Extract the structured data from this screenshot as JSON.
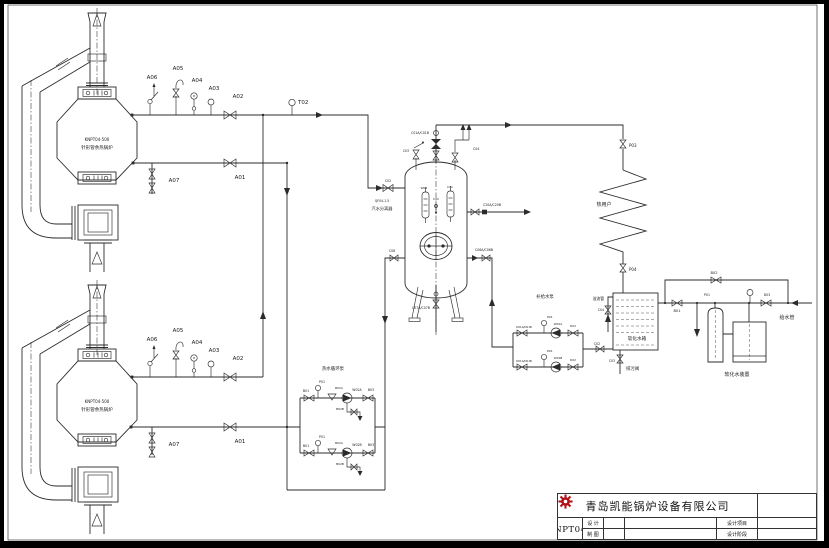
{
  "colors": {
    "line": "#2b2b2b",
    "background": "#ffffff",
    "frame": "#000000",
    "logo_red": "#b01217"
  },
  "title_block": {
    "company": "青岛凯能锅炉设备有限公司",
    "drawing_title": "2台KNPT04-500",
    "design_label": "设 计",
    "draft_label": "制 图",
    "project_label": "设计项目",
    "stage_label": "设计阶段"
  },
  "equipment": {
    "boiler_model": "KNPT04-500",
    "boiler_name": "针形管余热锅炉",
    "separator": "汽水分离器",
    "heat_user": "热用户",
    "soft_water_tank": "软化水箱",
    "softener_unit": "软化水装置",
    "makeup_pumps": "补给水泵",
    "circulation_pumps": "热水循环泵",
    "feed_pipe": "给水管",
    "overflow_pipe": "溢流管",
    "blowdown_valve": "排污阀"
  },
  "diagram": {
    "labels": [
      {
        "id": "boiler1-model",
        "t": "KNPT04-500",
        "x": 97,
        "y": 141,
        "fs": 4
      },
      {
        "id": "boiler1-name",
        "t": "针形管余热锅炉",
        "x": 97,
        "y": 149,
        "fs": 4.5
      },
      {
        "id": "tag-a06-1",
        "t": "A06",
        "x": 152,
        "y": 79,
        "fs": 5.5
      },
      {
        "id": "tag-a05-1",
        "t": "A05",
        "x": 178,
        "y": 70,
        "fs": 5.5
      },
      {
        "id": "tag-a04-1",
        "t": "A04",
        "x": 197,
        "y": 82,
        "fs": 5.5
      },
      {
        "id": "tag-a03-1",
        "t": "A03",
        "x": 214,
        "y": 90,
        "fs": 5.5
      },
      {
        "id": "tag-a02-1",
        "t": "A02",
        "x": 238,
        "y": 98,
        "fs": 5.5
      },
      {
        "id": "tag-a01-1",
        "t": "A01",
        "x": 240,
        "y": 179,
        "fs": 5.5
      },
      {
        "id": "tag-a07-1",
        "t": "A07",
        "x": 174,
        "y": 182,
        "fs": 5.5
      },
      {
        "id": "tag-t02",
        "t": "T02",
        "x": 298,
        "y": 104,
        "fs": 5.5,
        "a": "start"
      },
      {
        "id": "boiler2-model",
        "t": "KNPT04-500",
        "x": 97,
        "y": 403,
        "fs": 4
      },
      {
        "id": "boiler2-name",
        "t": "针形管余热锅炉",
        "x": 97,
        "y": 411,
        "fs": 4.5
      },
      {
        "id": "tag-a06-2",
        "t": "A06",
        "x": 152,
        "y": 341,
        "fs": 5.5
      },
      {
        "id": "tag-a05-2",
        "t": "A05",
        "x": 178,
        "y": 332,
        "fs": 5.5
      },
      {
        "id": "tag-a04-2",
        "t": "A04",
        "x": 197,
        "y": 344,
        "fs": 5.5
      },
      {
        "id": "tag-a03-2",
        "t": "A03",
        "x": 214,
        "y": 352,
        "fs": 5.5
      },
      {
        "id": "tag-a02-2",
        "t": "A02",
        "x": 238,
        "y": 360,
        "fs": 5.5
      },
      {
        "id": "tag-a01-2",
        "t": "A01",
        "x": 240,
        "y": 443,
        "fs": 5.5
      },
      {
        "id": "tag-a07-2",
        "t": "A07",
        "x": 174,
        "y": 446,
        "fs": 5.5
      },
      {
        "id": "separator-model",
        "t": "QF04-1.5",
        "x": 382,
        "y": 202,
        "fs": 3.2
      },
      {
        "id": "separator-name",
        "t": "汽水分离器",
        "x": 382,
        "y": 210,
        "fs": 4.2
      },
      {
        "id": "tag-c01",
        "t": "C01A/C01B",
        "x": 429,
        "y": 134,
        "fs": 3.2,
        "a": "end"
      },
      {
        "id": "tag-c03",
        "t": "C03",
        "x": 409,
        "y": 152,
        "fs": 3.2,
        "a": "end"
      },
      {
        "id": "tag-c04",
        "t": "C04",
        "x": 473,
        "y": 150,
        "fs": 3.2,
        "a": "start"
      },
      {
        "id": "tag-c02",
        "t": "C02",
        "x": 388,
        "y": 182,
        "fs": 3.2
      },
      {
        "id": "tag-w01",
        "t": "W01",
        "x": 424,
        "y": 189,
        "fs": 3
      },
      {
        "id": "tag-c21",
        "t": "C21",
        "x": 450,
        "y": 188,
        "fs": 3
      },
      {
        "id": "tag-c22",
        "t": "C22",
        "x": 436,
        "y": 200,
        "fs": 3
      },
      {
        "id": "tag-c20",
        "t": "C20A/C20B",
        "x": 492,
        "y": 206,
        "fs": 3.2
      },
      {
        "id": "tag-c08",
        "t": "C08",
        "x": 392,
        "y": 252,
        "fs": 3.2
      },
      {
        "id": "tag-c06",
        "t": "C06A/C06B",
        "x": 484,
        "y": 251,
        "fs": 3.2
      },
      {
        "id": "tag-c07",
        "t": "C07A/C07B",
        "x": 430,
        "y": 309,
        "fs": 3.2,
        "a": "end"
      },
      {
        "id": "tag-p03",
        "t": "P03",
        "x": 629,
        "y": 147,
        "fs": 4,
        "a": "start"
      },
      {
        "id": "heat-user-label",
        "t": "热用户",
        "x": 604,
        "y": 206,
        "fs": 5
      },
      {
        "id": "tag-p04",
        "t": "P04",
        "x": 629,
        "y": 271,
        "fs": 4,
        "a": "start"
      },
      {
        "id": "tag-b02-feed",
        "t": "B02",
        "x": 714,
        "y": 274,
        "fs": 3.6
      },
      {
        "id": "tag-b01-feed",
        "t": "B01",
        "x": 677,
        "y": 312,
        "fs": 3.6
      },
      {
        "id": "tag-p01-feed",
        "t": "P01",
        "x": 707,
        "y": 296,
        "fs": 3.2
      },
      {
        "id": "tag-d03-feed",
        "t": "D03",
        "x": 767,
        "y": 296,
        "fs": 3.2
      },
      {
        "id": "feed-pipe-label",
        "t": "给水管",
        "x": 787,
        "y": 319,
        "fs": 5
      },
      {
        "id": "soft-tank-label",
        "t": "软化水箱",
        "x": 637,
        "y": 340,
        "fs": 4.6
      },
      {
        "id": "softener-label",
        "t": "软化水装置",
        "x": 737,
        "y": 376,
        "fs": 5
      },
      {
        "id": "overflow-label",
        "t": "溢流管",
        "x": 604,
        "y": 300,
        "fs": 3.8,
        "a": "end"
      },
      {
        "id": "tag-c04-tank",
        "t": "C04",
        "x": 604,
        "y": 311,
        "fs": 3.2,
        "a": "end"
      },
      {
        "id": "tag-c02-tank",
        "t": "C02",
        "x": 597,
        "y": 345,
        "fs": 3.2
      },
      {
        "id": "tag-c03-tank",
        "t": "C03",
        "x": 615,
        "y": 362,
        "fs": 3.2,
        "a": "end"
      },
      {
        "id": "blowdown-label",
        "t": "排污阀",
        "x": 626,
        "y": 370,
        "fs": 4.4,
        "a": "start"
      },
      {
        "id": "makeup-pumps-label",
        "t": "补给水泵",
        "x": 545,
        "y": 298,
        "fs": 4.4
      },
      {
        "id": "tag-p01-mk1",
        "t": "P01",
        "x": 547,
        "y": 318,
        "fs": 3,
        "a": "start"
      },
      {
        "id": "tag-d01-mk1",
        "t": "D01A/D01B",
        "x": 524,
        "y": 328,
        "fs": 2.7
      },
      {
        "id": "tag-w01a",
        "t": "W01A",
        "x": 558,
        "y": 325,
        "fs": 2.9
      },
      {
        "id": "tag-d02-mk1",
        "t": "D02",
        "x": 573,
        "y": 327,
        "fs": 2.9
      },
      {
        "id": "tag-p01-mk2",
        "t": "P01",
        "x": 547,
        "y": 352,
        "fs": 3,
        "a": "start"
      },
      {
        "id": "tag-d01-mk2",
        "t": "D01A/D01B",
        "x": 524,
        "y": 362,
        "fs": 2.7
      },
      {
        "id": "tag-w01b",
        "t": "W01B",
        "x": 558,
        "y": 359,
        "fs": 2.9
      },
      {
        "id": "tag-d02-mk2",
        "t": "D02",
        "x": 573,
        "y": 361,
        "fs": 2.9
      },
      {
        "id": "circ-pumps-label",
        "t": "热水循环泵",
        "x": 333,
        "y": 370,
        "fs": 4.4
      },
      {
        "id": "tag-b01-c1",
        "t": "B01",
        "x": 306,
        "y": 392,
        "fs": 3.2
      },
      {
        "id": "tag-p01-c1",
        "t": "P01",
        "x": 322,
        "y": 383,
        "fs": 3.2
      },
      {
        "id": "tag-b02a-c1",
        "t": "B02A",
        "x": 339,
        "y": 389,
        "fs": 2.9
      },
      {
        "id": "tag-w02a",
        "t": "W02A",
        "x": 357,
        "y": 391,
        "fs": 3.2
      },
      {
        "id": "tag-b03-c1",
        "t": "B03",
        "x": 371,
        "y": 391,
        "fs": 3.2
      },
      {
        "id": "tag-b02b-c1",
        "t": "B02B",
        "x": 340,
        "y": 410,
        "fs": 2.9
      },
      {
        "id": "tag-b01-c2",
        "t": "B01",
        "x": 306,
        "y": 447,
        "fs": 3.2
      },
      {
        "id": "tag-p01-c2",
        "t": "P01",
        "x": 322,
        "y": 438,
        "fs": 3.2
      },
      {
        "id": "tag-b02a-c2",
        "t": "B02A",
        "x": 339,
        "y": 444,
        "fs": 2.9
      },
      {
        "id": "tag-w02b",
        "t": "W02B",
        "x": 357,
        "y": 446,
        "fs": 3.2
      },
      {
        "id": "tag-b03-c2",
        "t": "B03",
        "x": 371,
        "y": 446,
        "fs": 3.2
      },
      {
        "id": "tag-b02b-c2",
        "t": "B02B",
        "x": 340,
        "y": 465,
        "fs": 2.9
      }
    ]
  }
}
